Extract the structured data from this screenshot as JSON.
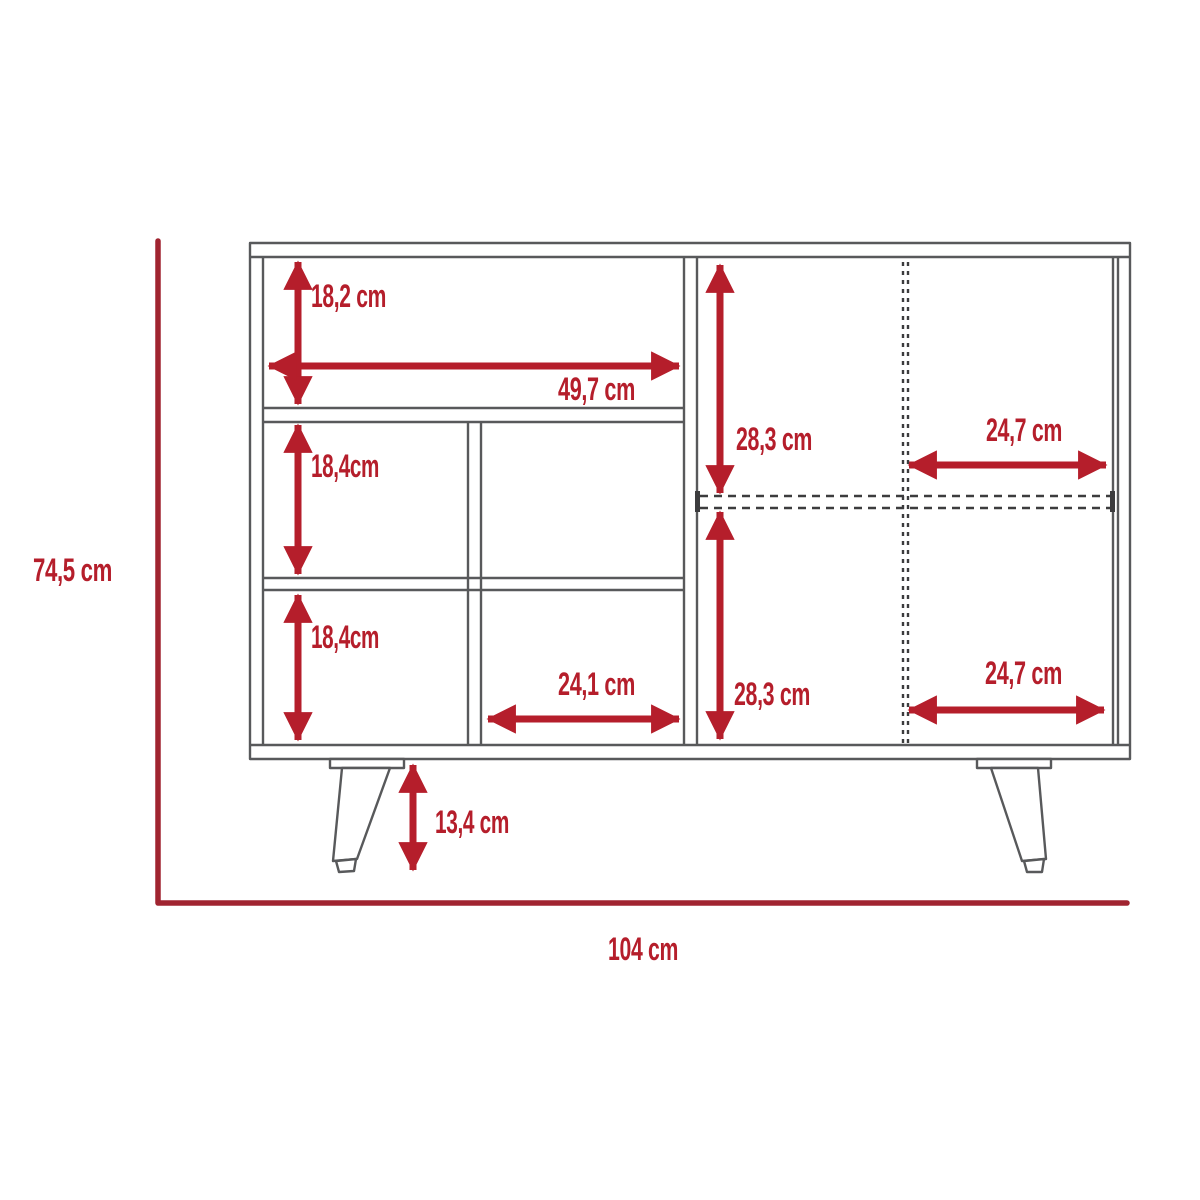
{
  "diagram": {
    "labels": {
      "shelf_top_height": "18,2 cm",
      "shelf_top_width": "49,7 cm",
      "shelf_mid_height": "18,4cm",
      "shelf_bottom_height": "18,4cm",
      "shelf_bottom_width": "24,1 cm",
      "door_top_height": "28,3 cm",
      "door_top_width": "24,7 cm",
      "door_bottom_height": "28,3 cm",
      "door_bottom_width": "24,7 cm",
      "leg_height": "13,4 cm",
      "overall_height": "74,5 cm",
      "overall_width": "104 cm"
    },
    "colors": {
      "dimension_red": "#B51E2B",
      "axis_red": "#A02430",
      "structure_gray": "#58595B",
      "dashed_dark": "#3C3C3E",
      "background": "#FFFFFF"
    }
  }
}
